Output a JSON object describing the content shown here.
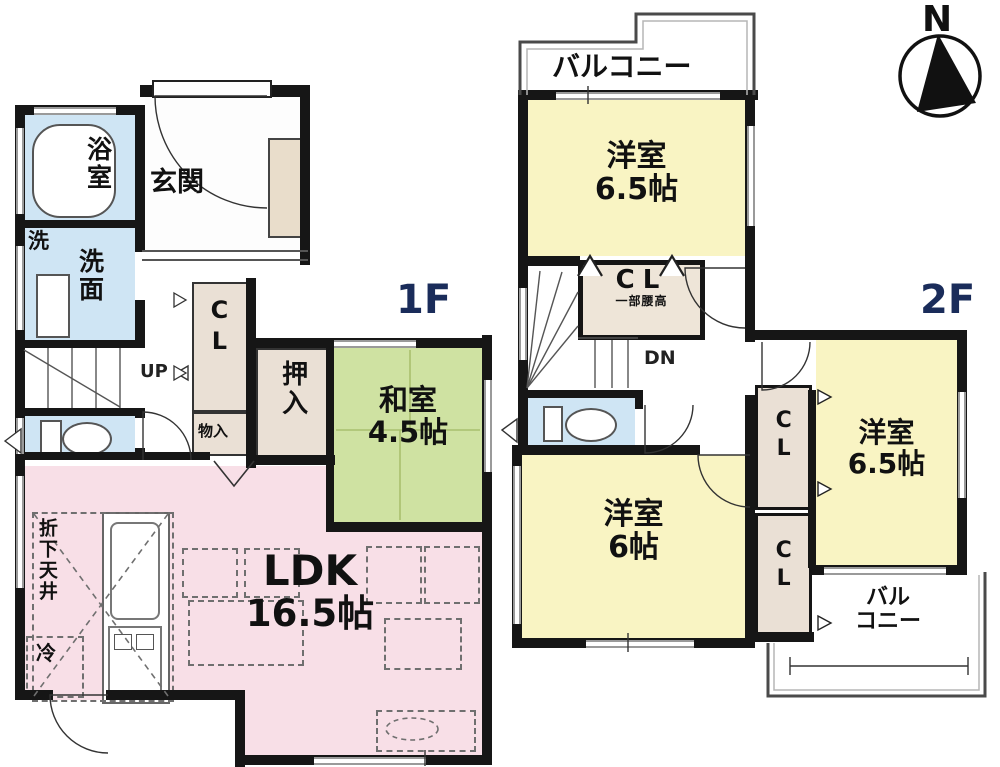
{
  "compass": {
    "north": "N"
  },
  "f1": {
    "floor_label": "1F",
    "genkan": "玄関",
    "bath": "浴室",
    "laundry": "洗",
    "washroom": "洗面",
    "up": "UP",
    "cl": "CL",
    "storage": "物入",
    "oshiire": "押入",
    "washitsu": "和室",
    "washitsu_size": "4.5帖",
    "ldk": "LDK",
    "ldk_size": "16.5帖",
    "lowered_ceiling": "折下天井",
    "fridge": "冷"
  },
  "f2": {
    "floor_label": "2F",
    "balcony": "バルコニー",
    "room_n": "洋室",
    "room_n_size": "6.5帖",
    "cl": "CL",
    "cl_note": "一部腰高",
    "dn": "DN",
    "room_w": "洋室",
    "room_w_size": "6帖",
    "cl_upper": "CL",
    "cl_lower": "CL",
    "room_e": "洋室",
    "room_e_size": "6.5帖",
    "balcony2_l1": "バル",
    "balcony2_l2": "コニー"
  },
  "colors": {
    "wall": "#161616",
    "water_blue": "#cfe5f4",
    "tatami_green": "#cfe2a2",
    "ldk_pink": "#f8dfe7",
    "bedroom_yellow": "#f9f4c3",
    "closet_beige": "#eae0d5",
    "floor_label_navy": "#1a2c5a"
  }
}
